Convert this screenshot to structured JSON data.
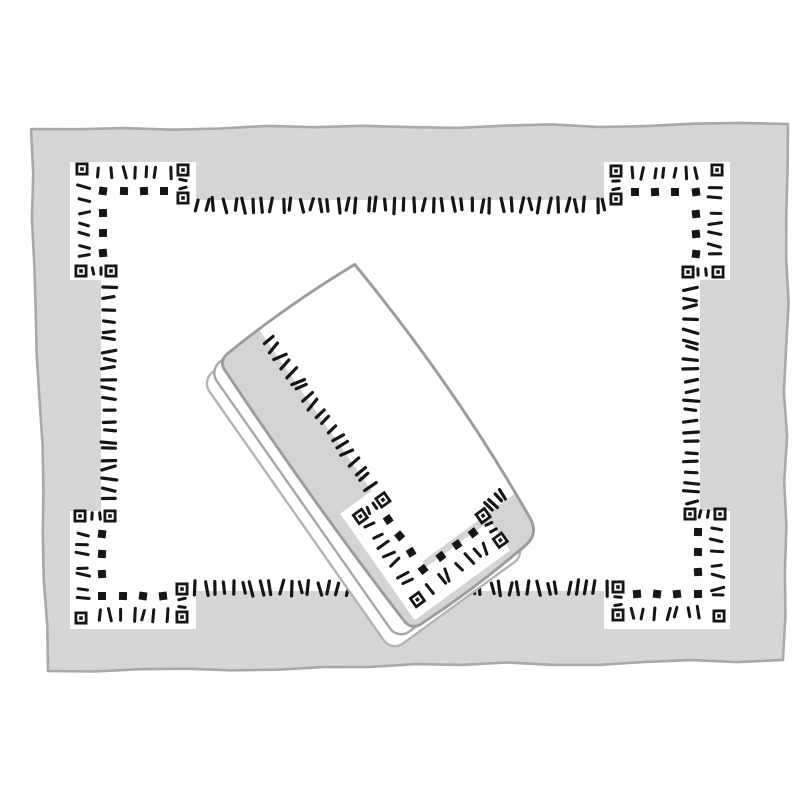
{
  "scene": {
    "description": "Hand-drawn illustration of a gray placemat with hemstitched embroidery border and a folded white napkin with matching hemstitch embroidery lying diagonally on top",
    "width": 800,
    "height": 800,
    "background": "#ffffff"
  },
  "palette": {
    "mat_fill": "#d6d6d6",
    "mat_outline": "#a9a9a9",
    "panel_fill": "#ffffff",
    "stitch": "#161616",
    "napkin_face": "#ffffff",
    "napkin_outline": "#9c9c9c",
    "napkin_band": "#d4d4d4",
    "fold_outline_1": "#a6a6a6",
    "fold_outline_2": "#b4b4b4"
  },
  "placemat": {
    "outline_points": [
      [
        31,
        129
      ],
      [
        788,
        124
      ],
      [
        783,
        660
      ],
      [
        48,
        671
      ]
    ],
    "outline_width": 2.6,
    "panel_rect": [
      101,
      200,
      599,
      391
    ],
    "notch_rects": [
      [
        70,
        162,
        126,
        40
      ],
      [
        70,
        162,
        33,
        118
      ],
      [
        604,
        162,
        126,
        40
      ],
      [
        697,
        162,
        33,
        118
      ],
      [
        70,
        589,
        126,
        40
      ],
      [
        70,
        511,
        33,
        118
      ],
      [
        604,
        589,
        126,
        40
      ],
      [
        697,
        511,
        33,
        118
      ]
    ],
    "dash_rows": [
      {
        "x1": 191,
        "y1": 205,
        "x2": 610,
        "y2": 205,
        "n": 44,
        "len": 13
      },
      {
        "x1": 191,
        "y1": 588,
        "x2": 610,
        "y2": 588,
        "n": 44,
        "len": 13
      },
      {
        "x1": 109,
        "y1": 284,
        "x2": 109,
        "y2": 506,
        "n": 22,
        "len": 13
      },
      {
        "x1": 691,
        "y1": 284,
        "x2": 691,
        "y2": 506,
        "n": 22,
        "len": 13
      }
    ],
    "motif_anchors": [
      {
        "x": 82,
        "y": 169,
        "sx": 1,
        "sy": 1
      },
      {
        "x": 717,
        "y": 170,
        "sx": -1,
        "sy": 1
      },
      {
        "x": 81,
        "y": 618,
        "sx": 1,
        "sy": -1
      },
      {
        "x": 719,
        "y": 616,
        "sx": -1,
        "sy": -1
      }
    ]
  },
  "motif": {
    "xsquare_size": 13,
    "solid_size": 8,
    "corner": [
      0,
      0
    ],
    "stacked_pair": [
      [
        101,
        1
      ],
      [
        101,
        29
      ]
    ],
    "side_pair": [
      [
        -1,
        102
      ],
      [
        29,
        102
      ]
    ],
    "stacked_ticks": [
      [
        101,
        11
      ],
      [
        101,
        19
      ]
    ],
    "side_ticks": [
      [
        11,
        102
      ],
      [
        19,
        102
      ]
    ],
    "arm_h": {
      "x1": 13,
      "y1": 3,
      "x2": 92,
      "y2": 3,
      "n": 7,
      "len": 11
    },
    "arm_v": {
      "x1": 2,
      "y1": 13,
      "x2": 2,
      "y2": 92,
      "n": 7,
      "len": 11
    },
    "solids": [
      [
        21,
        22
      ],
      [
        42,
        22
      ],
      [
        62,
        22
      ],
      [
        82,
        22
      ],
      [
        21,
        44
      ],
      [
        21,
        64
      ],
      [
        21,
        84
      ]
    ]
  },
  "napkin": {
    "matrix": [
      0.573,
      0.818,
      -0.807,
      0.59,
      353,
      262
    ],
    "face_path": "M 3,0 Q 165,-12 312,2 Q 330,4 331,22 Q 336,85 333,148 Q 334,162 322,164 Q 168,171 10,167 Q 1,166 0,156 Q -4,80 3,0 Z",
    "face_stroke_width": 2.8,
    "layers": [
      {
        "x": 6,
        "y": 26,
        "w": 332,
        "h": 166,
        "r": 14,
        "stroke": "fold_outline_2"
      },
      {
        "x": 2,
        "y": 13,
        "w": 330,
        "h": 167,
        "r": 14,
        "stroke": "fold_outline_1"
      }
    ],
    "layer_stroke_width": 2.4,
    "band_rects": [
      [
        -6,
        116,
        344,
        58
      ],
      [
        283,
        -6,
        55,
        180
      ]
    ],
    "notch_rects": [
      [
        196,
        115,
        130,
        40
      ],
      [
        290,
        37,
        36,
        118
      ]
    ],
    "dash_rows": [
      {
        "x1": 8,
        "y1": 114,
        "x2": 196,
        "y2": 114,
        "n": 19,
        "len": 12
      },
      {
        "x1": 277,
        "y1": 6,
        "x2": 277,
        "y2": 34,
        "n": 4,
        "len": 11
      }
    ],
    "motif_anchor": {
      "x": 311,
      "y": 141,
      "sx": -1,
      "sy": -1
    }
  },
  "stitch_style": {
    "tick_width": 3.2,
    "pair_tick_len": 6.5,
    "pair_tick_width": 3.0,
    "angle_jitter_deg": 34,
    "random_seed": 42
  }
}
